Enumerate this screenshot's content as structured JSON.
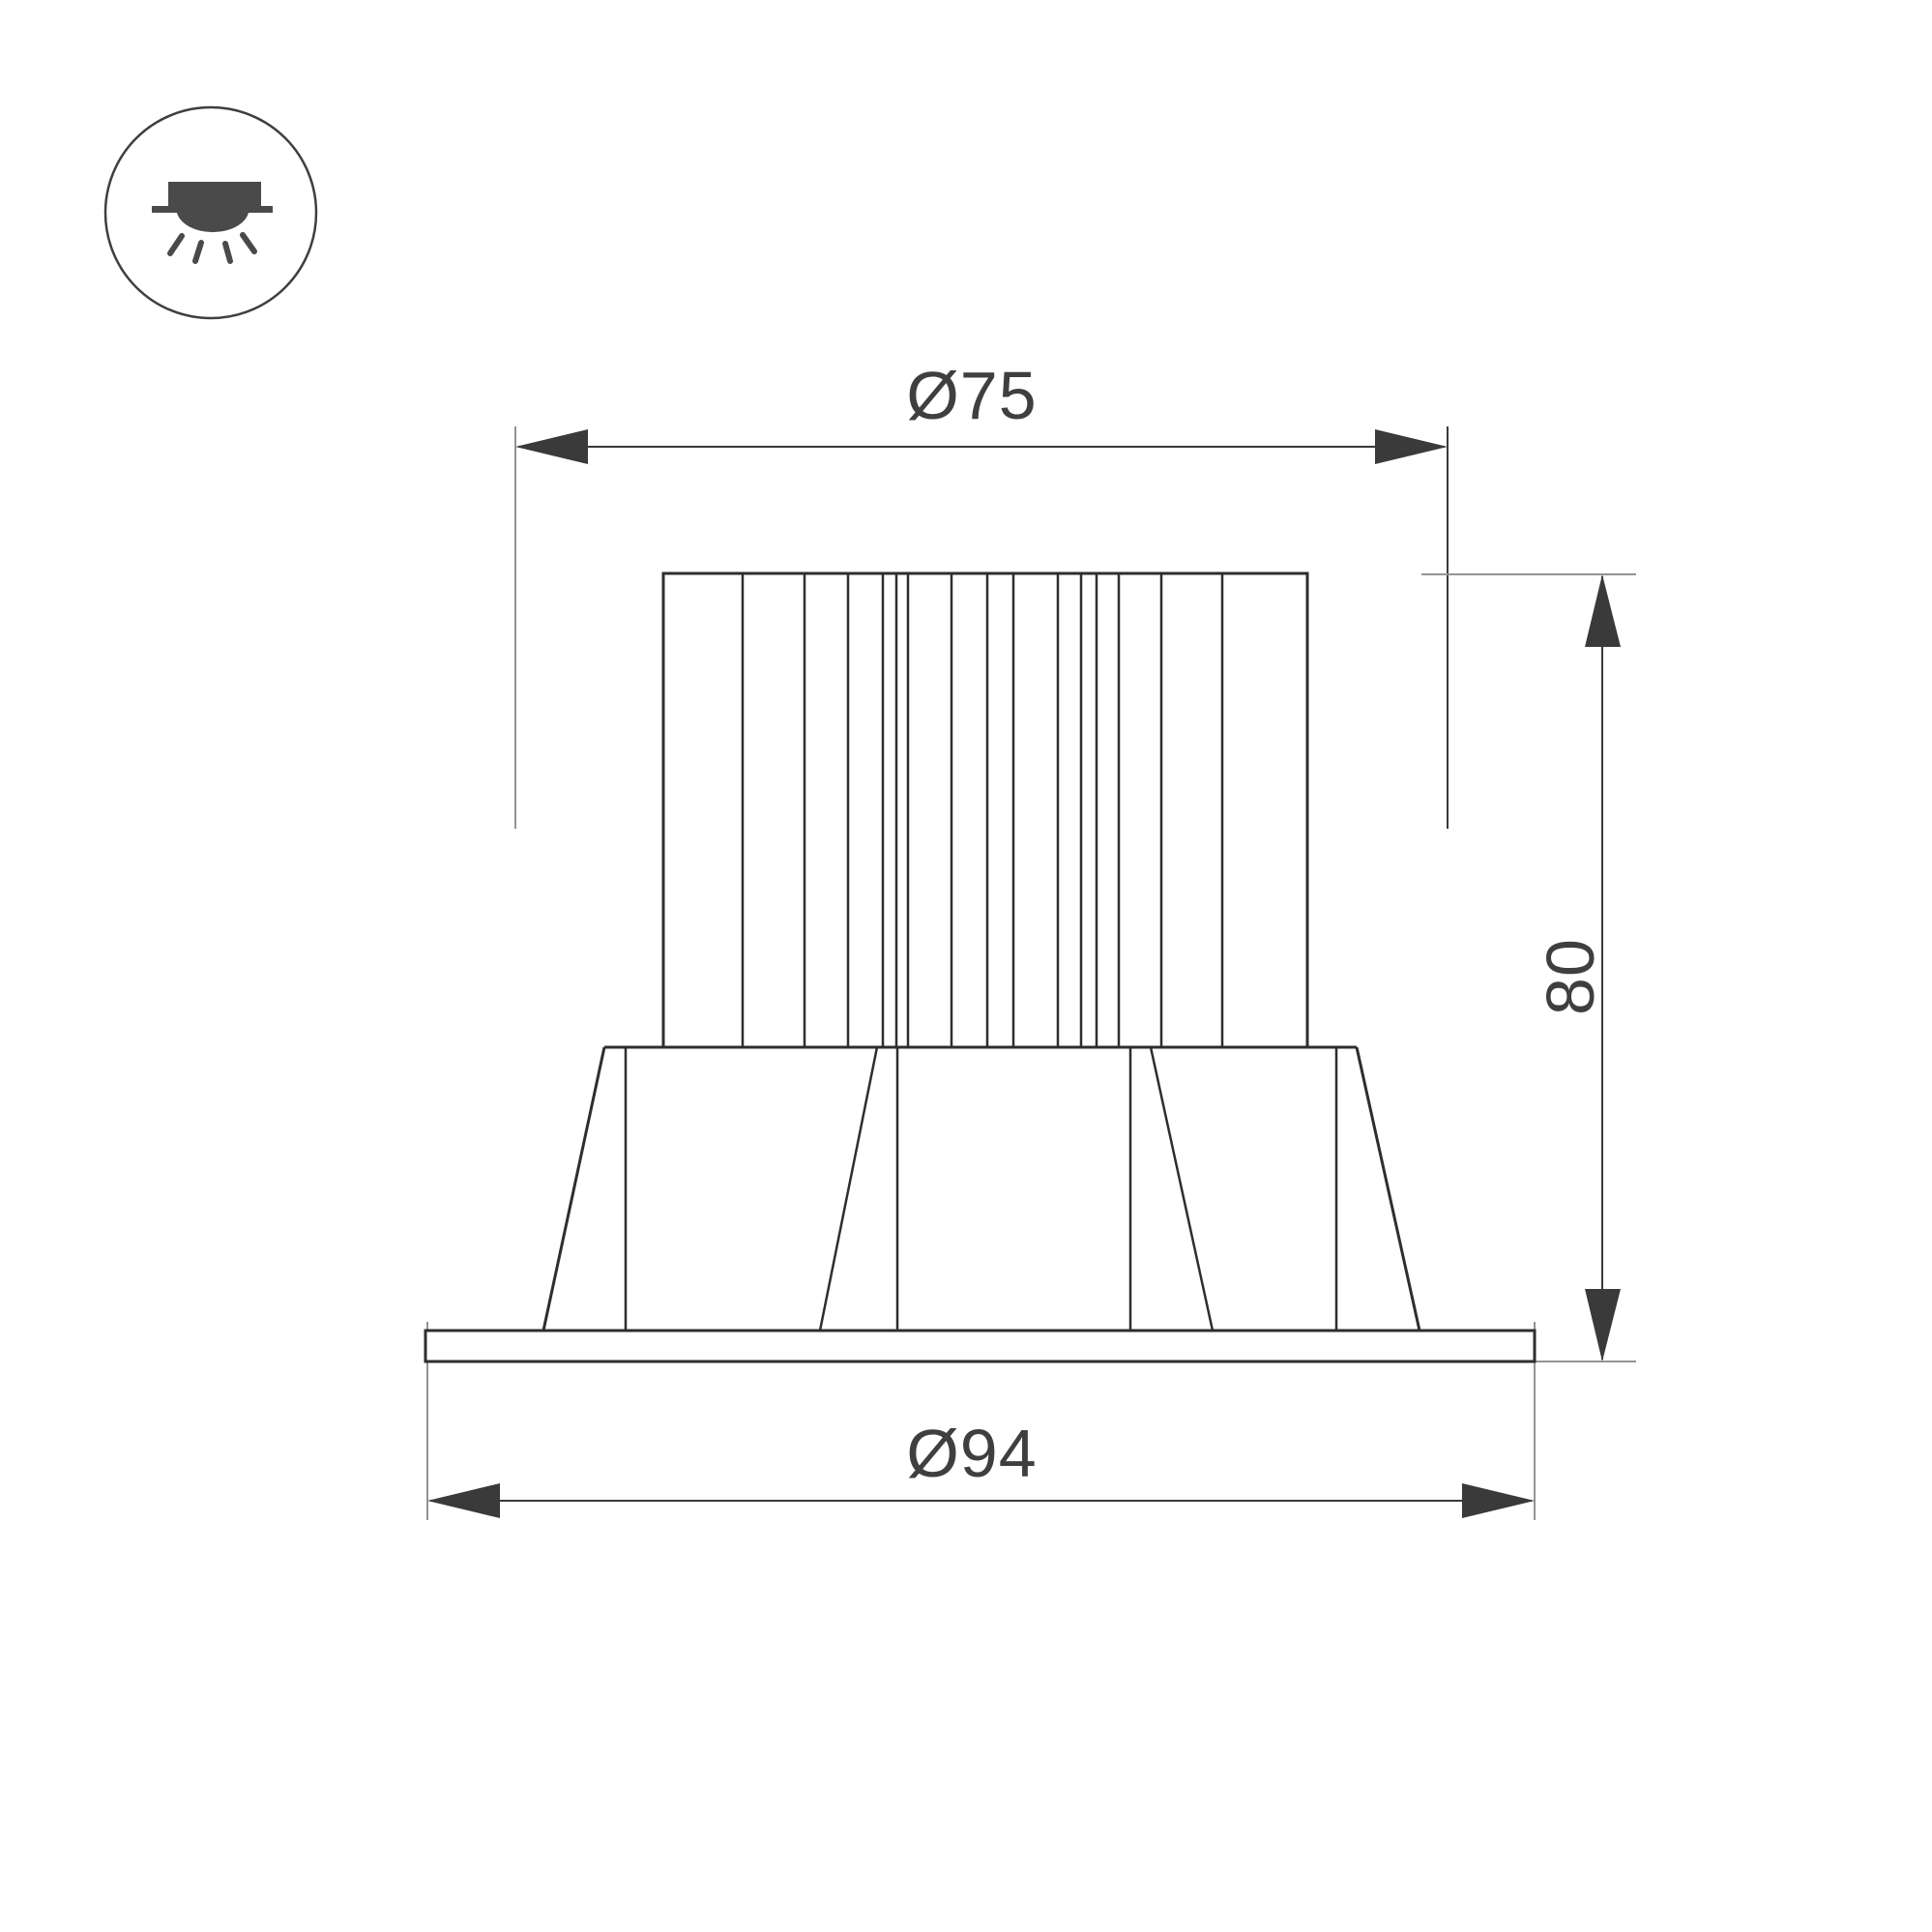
{
  "colors": {
    "background": "#ffffff",
    "outline": "#2e2e2e",
    "dimension": "#3a3a3a",
    "extension": "#949494",
    "text": "#3f3f3f",
    "icon_fill": "#4a4a4a"
  },
  "icon": {
    "type": "recessed-downlight-symbol"
  },
  "drawing": {
    "type": "technical-dimension-drawing",
    "subject": "recessed LED downlight, side elevation",
    "dimensions": {
      "top_diameter": "Ø75",
      "height": "80",
      "bottom_diameter": "Ø94"
    }
  }
}
